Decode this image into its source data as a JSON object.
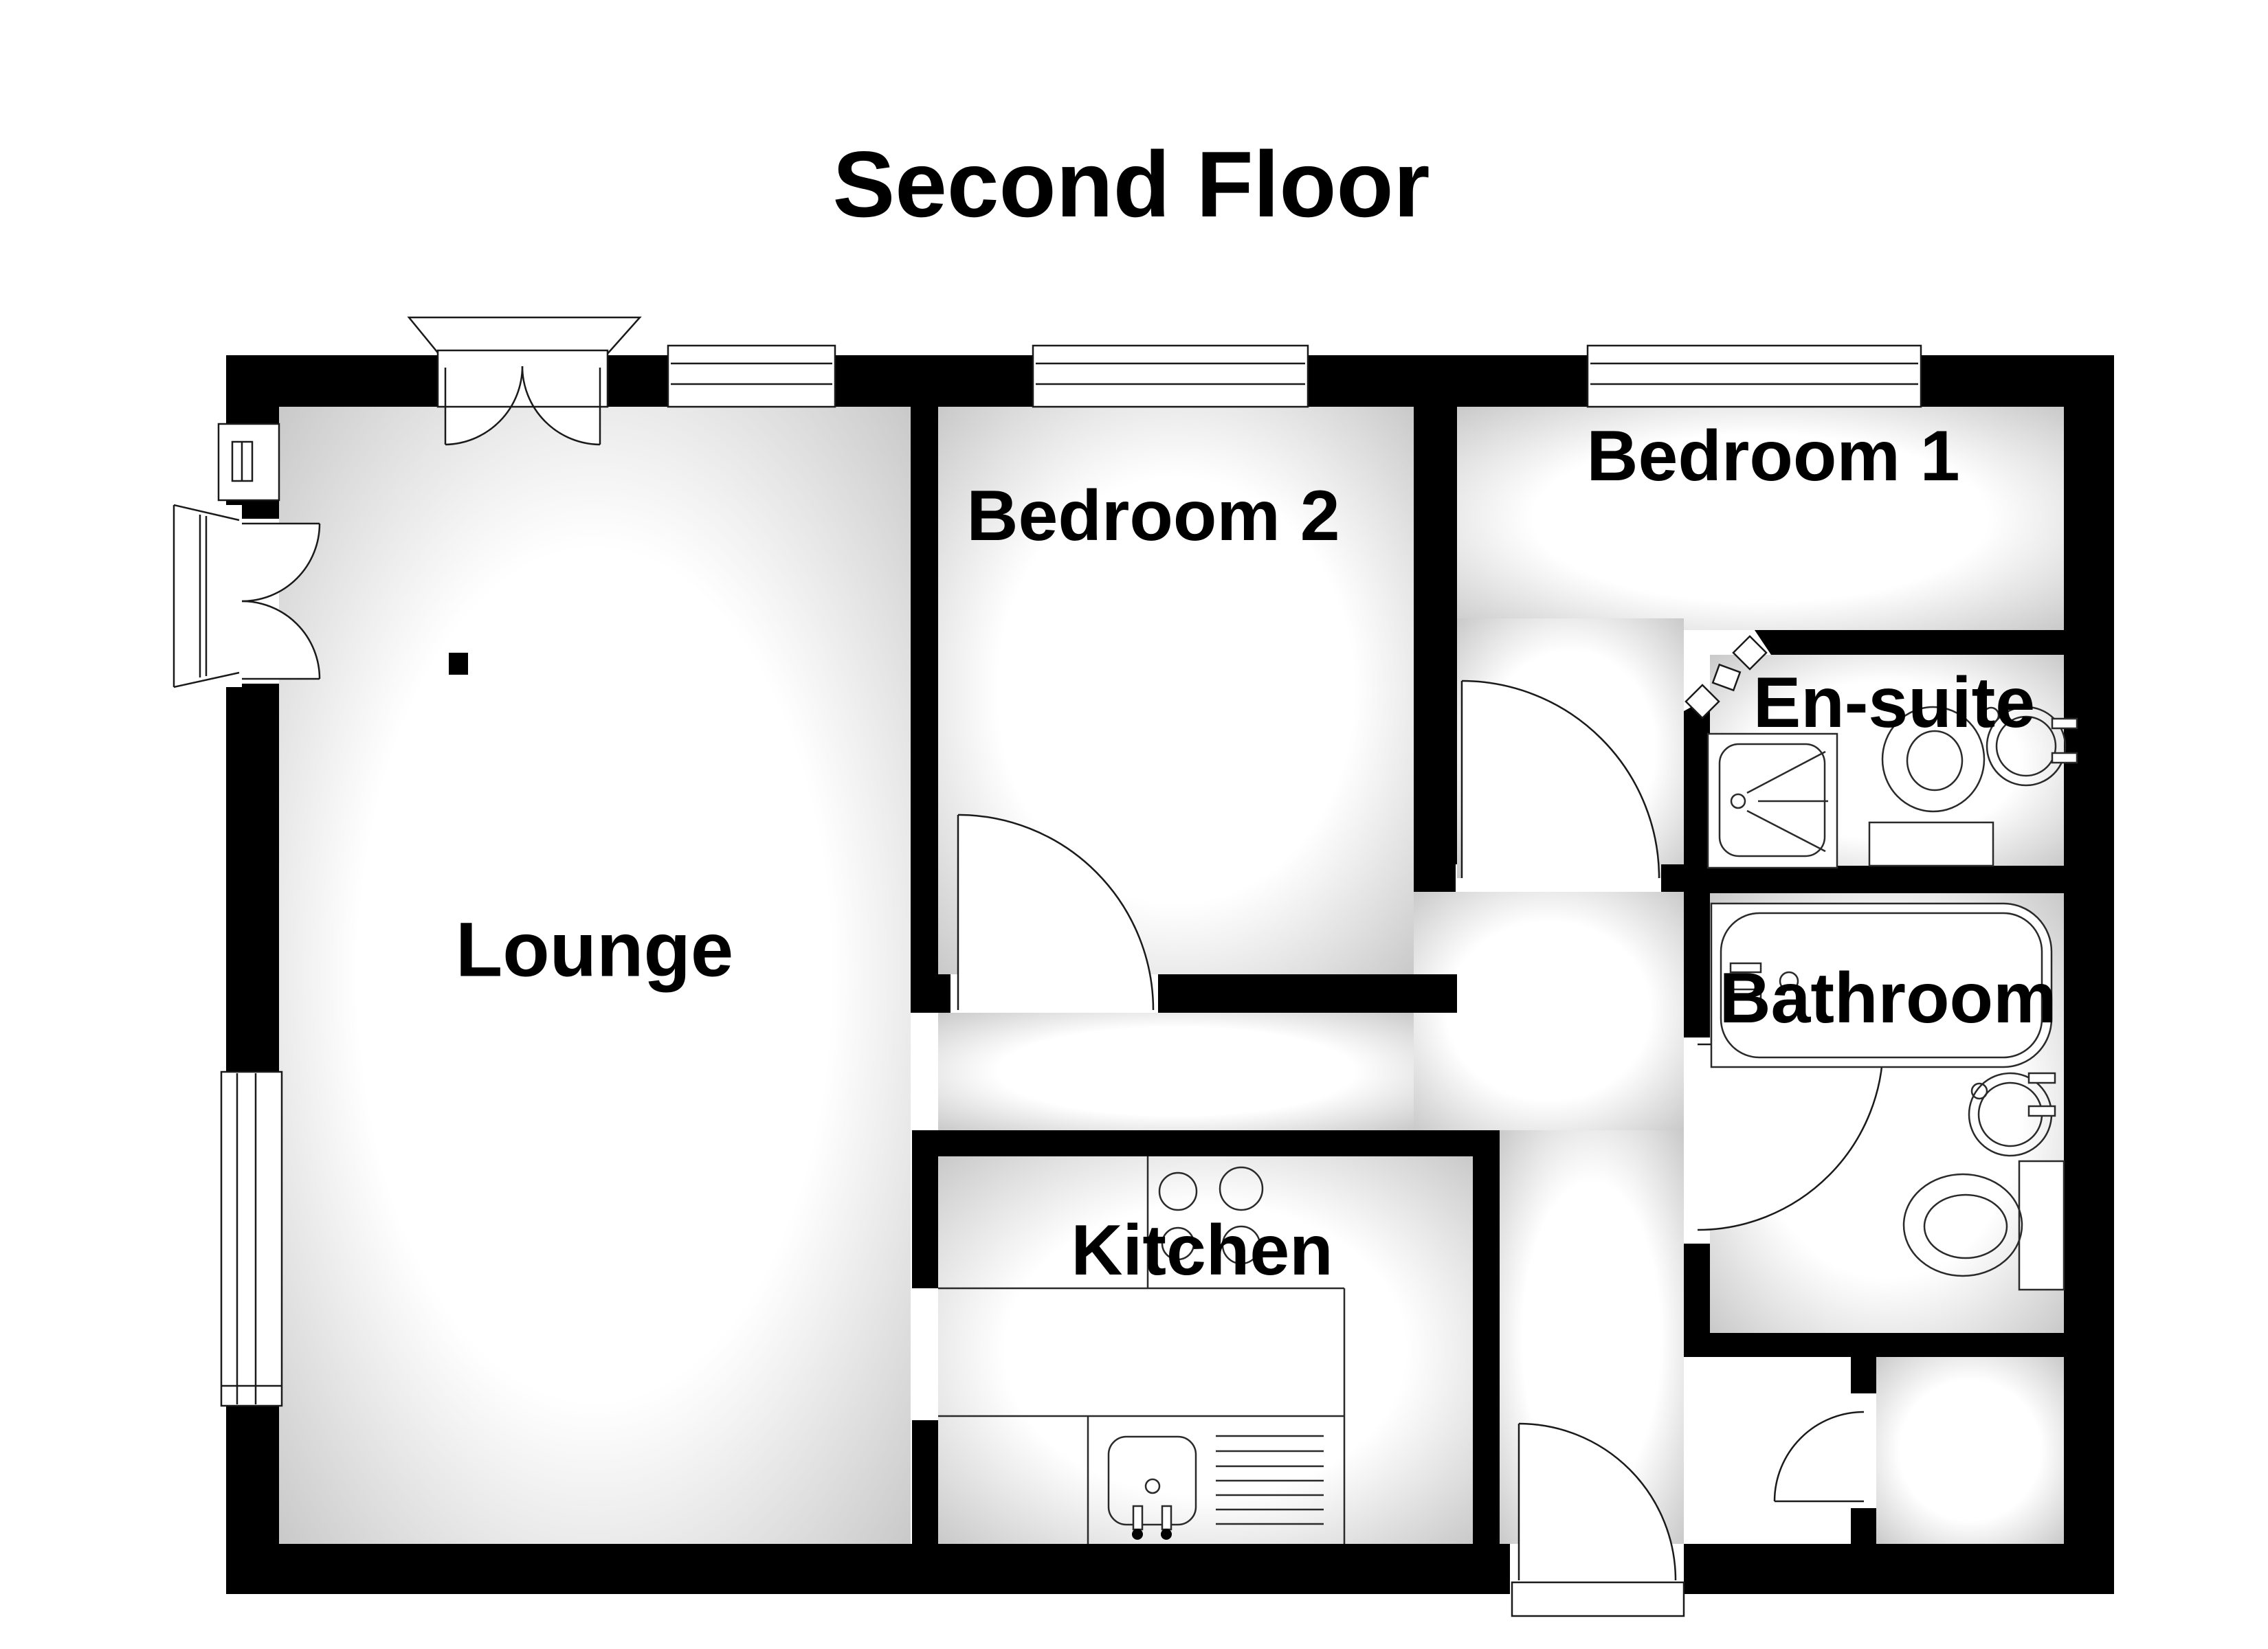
{
  "title": "Second Floor",
  "colors": {
    "wall": "#000000",
    "line": "#1a1a1a",
    "floor_shadow": "#c2c2c2",
    "background": "#ffffff"
  },
  "rooms": {
    "lounge": {
      "label": "Lounge"
    },
    "bedroom2": {
      "label": "Bedroom 2"
    },
    "bedroom1": {
      "label": "Bedroom 1"
    },
    "ensuite": {
      "label": "En-suite"
    },
    "bathroom": {
      "label": "Bathroom"
    },
    "kitchen": {
      "label": "Kitchen"
    }
  }
}
